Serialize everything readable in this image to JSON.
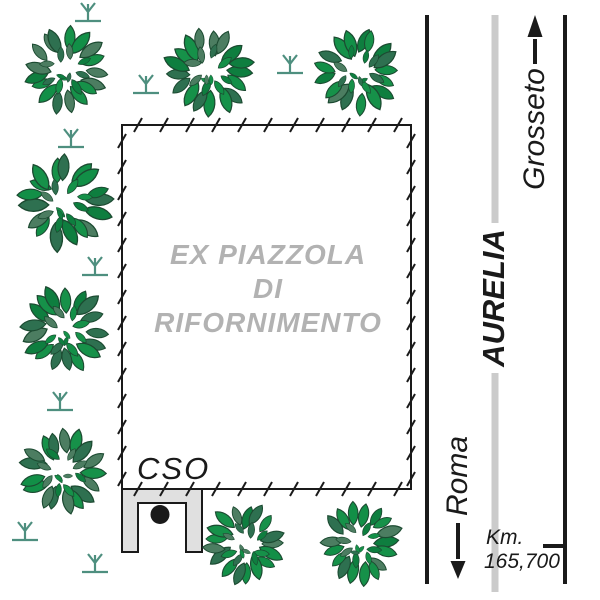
{
  "site": {
    "area_label_lines": [
      "EX PIAZZOLA",
      "DI",
      "RIFORNIMENTO"
    ],
    "cso_label": "CSO"
  },
  "road": {
    "name": "AURELIA",
    "north_destination": "Grosseto",
    "south_destination": "Roma",
    "km_label": "Km.",
    "km_value": "165,700"
  },
  "colors": {
    "line_black": "#1a1a1a",
    "road_gray": "#cbcbcb",
    "area_label_gray": "#b2b2b2",
    "structure_gray": "#e0e0e0",
    "grass_teal": "#4e8f7f",
    "leaf_outline": "#1c4a31",
    "leaf_palette": [
      "#128f47",
      "#0e7e3f",
      "#4c7d61",
      "#169149",
      "#2e7050"
    ]
  },
  "map": {
    "enclosure": {
      "x": 122,
      "y": 125,
      "w": 289,
      "h": 364,
      "hatch_step": 26,
      "hatch_first": 16
    },
    "trees": [
      {
        "x": 66,
        "y": 70,
        "r": 45
      },
      {
        "x": 210,
        "y": 71,
        "r": 45
      },
      {
        "x": 358,
        "y": 71,
        "r": 45
      },
      {
        "x": 64,
        "y": 203,
        "r": 48
      },
      {
        "x": 65,
        "y": 330,
        "r": 45
      },
      {
        "x": 63,
        "y": 472,
        "r": 44
      },
      {
        "x": 245,
        "y": 544,
        "r": 42
      },
      {
        "x": 360,
        "y": 544,
        "r": 42
      }
    ],
    "grasses": [
      {
        "x": 88,
        "y": 21
      },
      {
        "x": 146,
        "y": 93
      },
      {
        "x": 290,
        "y": 73
      },
      {
        "x": 71,
        "y": 147
      },
      {
        "x": 95,
        "y": 275
      },
      {
        "x": 60,
        "y": 410
      },
      {
        "x": 25,
        "y": 540
      },
      {
        "x": 95,
        "y": 572
      }
    ],
    "road_lines": {
      "left_x": 427,
      "right_x": 565,
      "center_x": 495,
      "top_y": 15,
      "bottom_y": 584,
      "gray_bottom_y": 592
    },
    "arrow_up": {
      "x": 535,
      "tip_y": 15,
      "head_base_y": 37,
      "tail_y": 64,
      "half_w": 7.5
    },
    "arrow_down": {
      "x": 458,
      "tip_y": 579,
      "head_base_y": 561,
      "tail_y": 523,
      "half_w": 7.5
    },
    "km_tick": {
      "x1": 543,
      "x2": 566,
      "y": 546
    },
    "structure": {
      "x": 122,
      "y": 489,
      "w": 80,
      "bar_h": 14,
      "leg_w": 16,
      "total_h": 63,
      "dot_x": 160,
      "dot_y": 514.5,
      "dot_r": 9.5
    }
  }
}
